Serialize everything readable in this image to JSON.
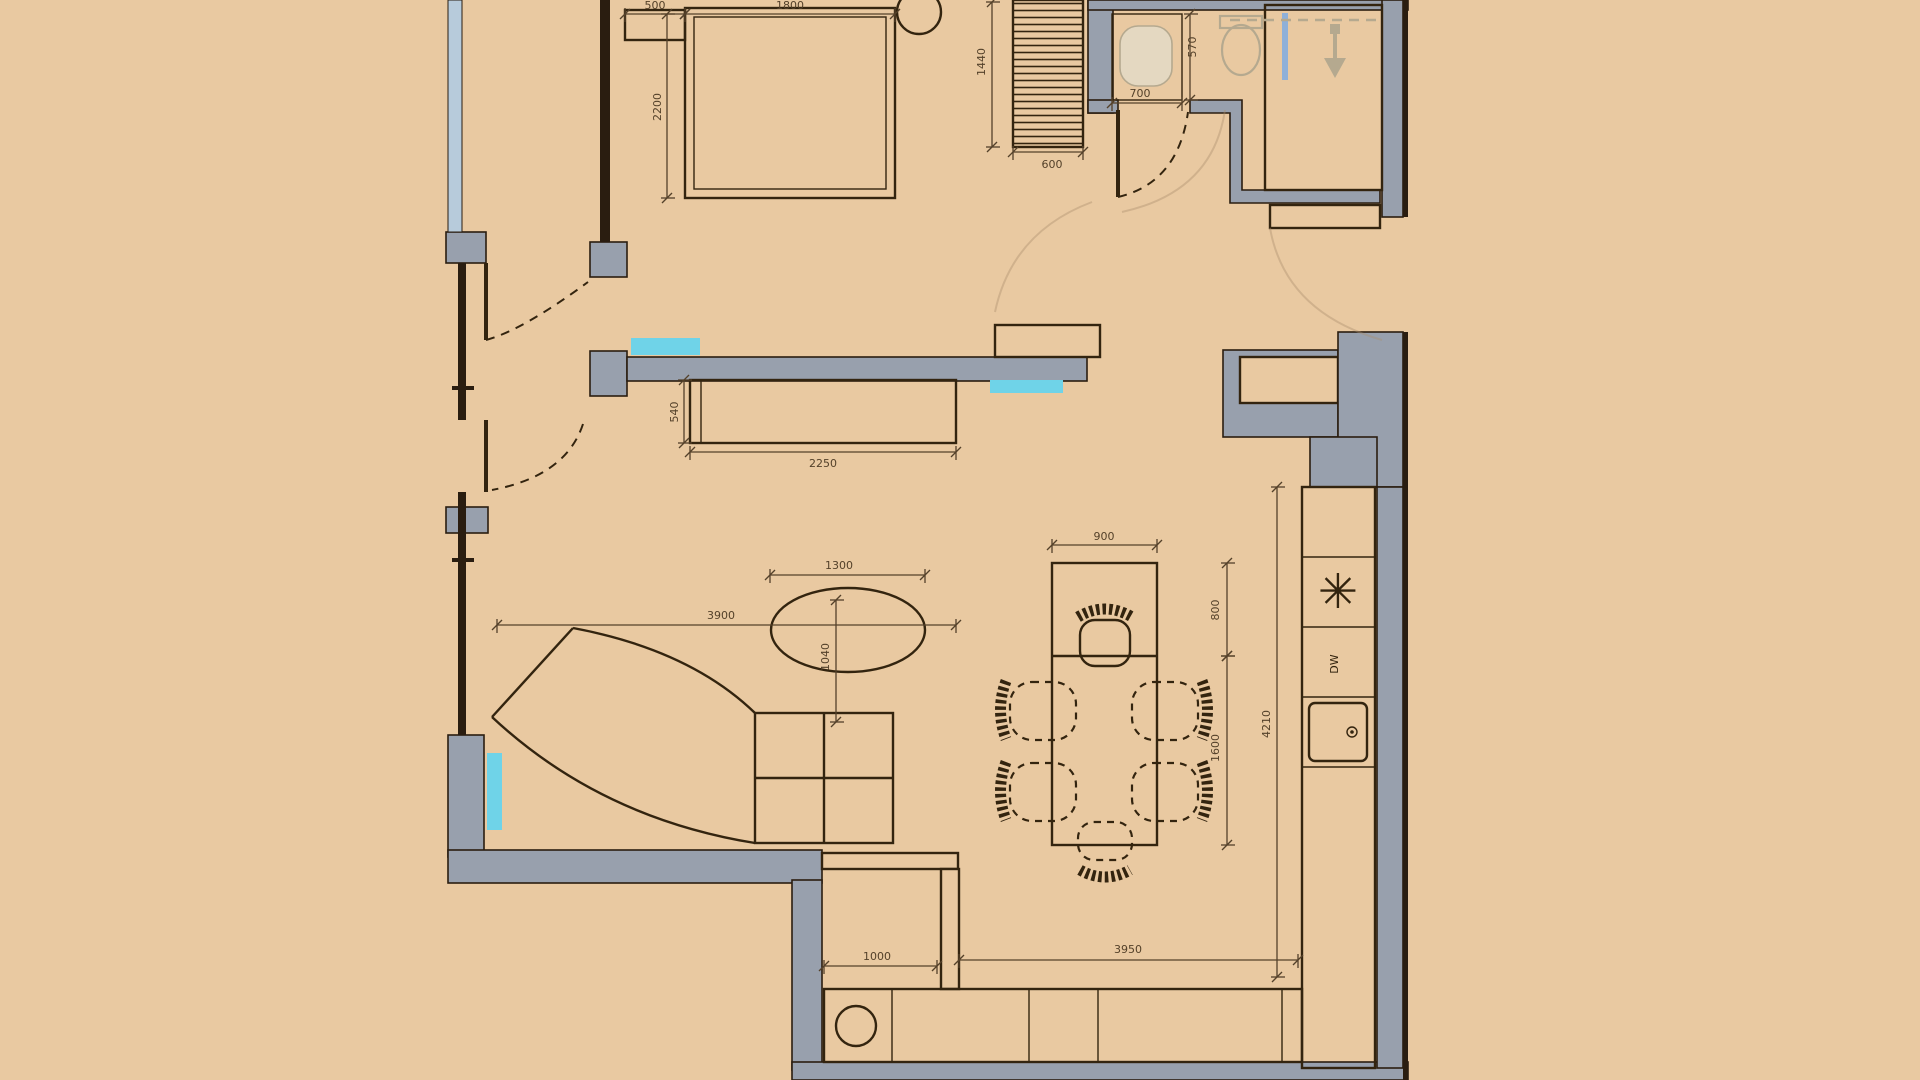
{
  "meta": {
    "drawing_type": "apartment floor plan, top view CAD drawing"
  },
  "colors": {
    "bg": "#e9c9a1",
    "wall_fill": "#98a0ad",
    "wall_line": "#2a1d10",
    "furniture_line": "#33240f",
    "dim_color": "#54412a",
    "window_blue": "#b7cbdb",
    "radiator_cyan": "#6fd3e8",
    "glass_blue": "#8fb0d8",
    "fixture_line": "#b5a98f",
    "fixture_fill": "#e4d8c1"
  },
  "labels": {
    "dishwasher": "DW",
    "stove_symbol": "✳"
  },
  "fixtures": [
    "bed",
    "nightstand",
    "round-side-table",
    "wardrobe",
    "bathroom-sink",
    "toilet",
    "shower",
    "tv-cabinet",
    "sofa",
    "coffee-table",
    "dining-table",
    "dining-chairs",
    "kitchen-counter",
    "cooktop",
    "dishwasher",
    "kitchen-sink",
    "bottom-counter",
    "washing-machine"
  ],
  "floorplan": {
    "dimensions": [
      {
        "label": "500",
        "x1": 625,
        "y1": 14,
        "x2": 685,
        "y2": 14,
        "lx": 655,
        "ly": 9,
        "rot": 0
      },
      {
        "label": "1800",
        "x1": 685,
        "y1": 14,
        "x2": 895,
        "y2": 14,
        "lx": 790,
        "ly": 9,
        "rot": 0
      },
      {
        "label": "2200",
        "x1": 667,
        "y1": 14,
        "x2": 667,
        "y2": 198,
        "lx": 661,
        "ly": 107,
        "rot": -90
      },
      {
        "label": "1440",
        "x1": 992,
        "y1": 2,
        "x2": 992,
        "y2": 147,
        "lx": 985,
        "ly": 62,
        "rot": -90
      },
      {
        "label": "600",
        "x1": 1013,
        "y1": 152,
        "x2": 1083,
        "y2": 152,
        "lx": 1052,
        "ly": 168,
        "rot": 0
      },
      {
        "label": "700",
        "x1": 1112,
        "y1": 103,
        "x2": 1182,
        "y2": 103,
        "lx": 1140,
        "ly": 97,
        "rot": 0
      },
      {
        "label": "570",
        "x1": 1190,
        "y1": 14,
        "x2": 1190,
        "y2": 100,
        "lx": 1196,
        "ly": 47,
        "rot": -90
      },
      {
        "label": "540",
        "x1": 684,
        "y1": 380,
        "x2": 684,
        "y2": 443,
        "lx": 678,
        "ly": 412,
        "rot": -90
      },
      {
        "label": "2250",
        "x1": 690,
        "y1": 452,
        "x2": 956,
        "y2": 452,
        "lx": 823,
        "ly": 467,
        "rot": 0
      },
      {
        "label": "3900",
        "x1": 497,
        "y1": 625,
        "x2": 956,
        "y2": 625,
        "lx": 721,
        "ly": 619,
        "rot": 0
      },
      {
        "label": "1300",
        "x1": 770,
        "y1": 575,
        "x2": 925,
        "y2": 575,
        "lx": 839,
        "ly": 569,
        "rot": 0
      },
      {
        "label": "1040",
        "x1": 836,
        "y1": 600,
        "x2": 836,
        "y2": 722,
        "lx": 829,
        "ly": 657,
        "rot": -90
      },
      {
        "label": "900",
        "x1": 1052,
        "y1": 545,
        "x2": 1157,
        "y2": 545,
        "lx": 1104,
        "ly": 540,
        "rot": 0
      },
      {
        "label": "800",
        "x1": 1227,
        "y1": 563,
        "x2": 1227,
        "y2": 656,
        "lx": 1219,
        "ly": 610,
        "rot": -90
      },
      {
        "label": "1600",
        "x1": 1227,
        "y1": 656,
        "x2": 1227,
        "y2": 845,
        "lx": 1219,
        "ly": 748,
        "rot": -90
      },
      {
        "label": "4210",
        "x1": 1277,
        "y1": 487,
        "x2": 1277,
        "y2": 977,
        "lx": 1270,
        "ly": 724,
        "rot": -90
      },
      {
        "label": "1000",
        "x1": 824,
        "y1": 966,
        "x2": 937,
        "y2": 966,
        "lx": 877,
        "ly": 960,
        "rot": 0
      },
      {
        "label": "3950",
        "x1": 959,
        "y1": 960,
        "x2": 1298,
        "y2": 960,
        "lx": 1128,
        "ly": 953,
        "rot": 0
      }
    ]
  }
}
